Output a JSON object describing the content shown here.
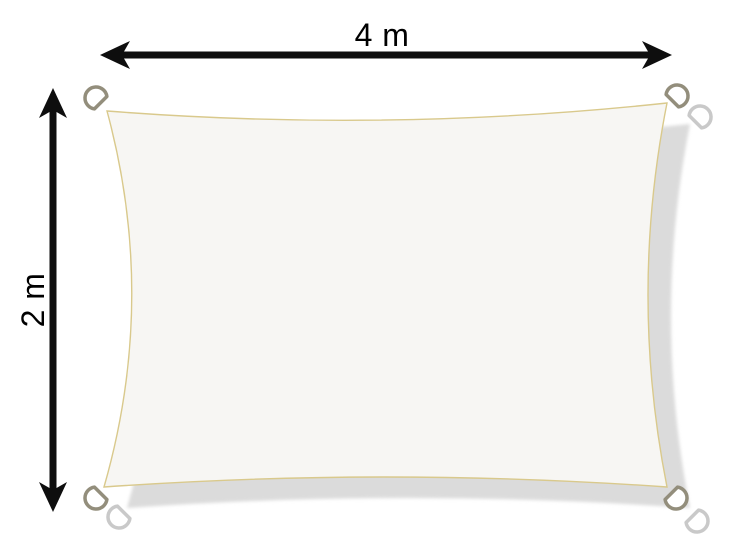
{
  "dimensions": {
    "width": {
      "label": "4 m",
      "value": 4,
      "unit": "m"
    },
    "height": {
      "label": "2 m",
      "value": 2,
      "unit": "m"
    }
  },
  "product": {
    "kind": "rectangular-shade-sail",
    "attachment_points": [
      "top-left",
      "top-right",
      "bottom-left",
      "bottom-right"
    ]
  },
  "colors": {
    "background": "#ffffff",
    "dimension_arrow": "#0e0e0e",
    "dimension_text": "#000000",
    "sail_fill": "#f7f6f3",
    "sail_seam": "#d9c98c",
    "shadow_fill": "#dbdbdb",
    "ring_stroke": "#938e7c",
    "ring_fill": "#ffffff",
    "shadow_ring_stroke": "#c9c9c9"
  }
}
